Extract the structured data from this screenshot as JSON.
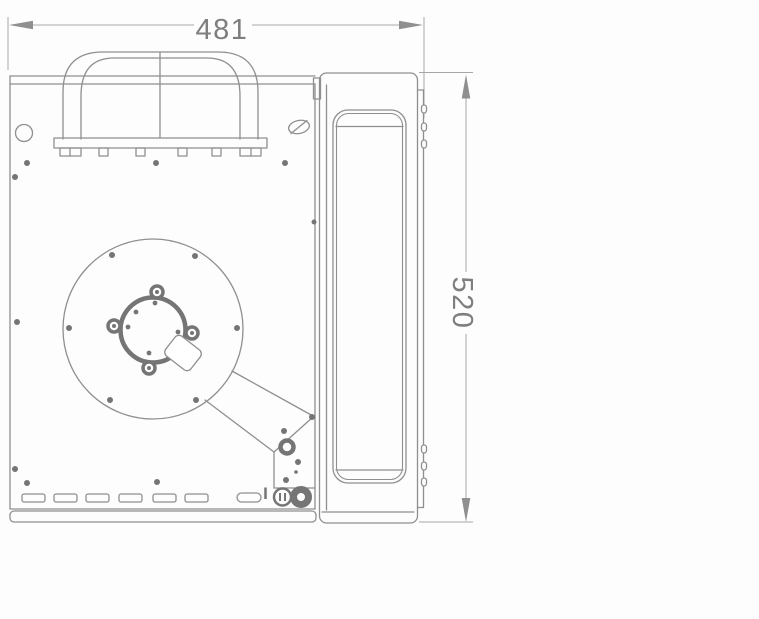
{
  "drawing": {
    "dim_width": {
      "value": "481"
    },
    "dim_height": {
      "value": "520"
    },
    "colors": {
      "background": "#fdfdfd",
      "line": "#8f8f8f",
      "line_dark": "#757575",
      "dim_line": "#a6a6a6",
      "dim_text": "#7e7e7e"
    }
  }
}
